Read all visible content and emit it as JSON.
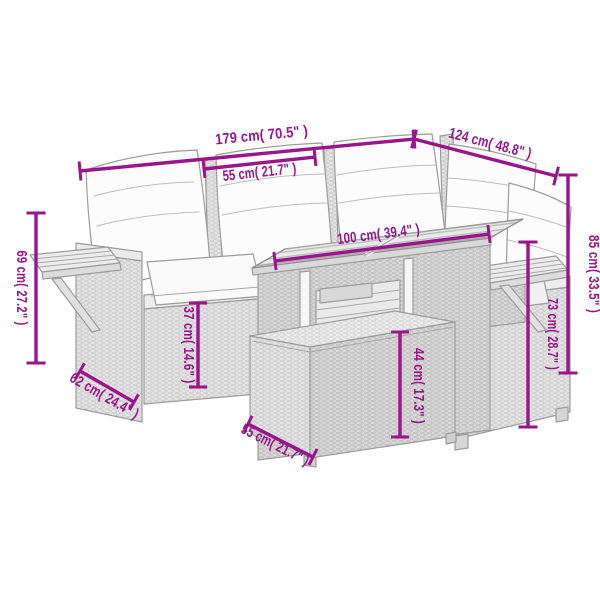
{
  "illustration": {
    "alt": "Line drawing of a 5-piece grey poly rattan garden lounge set: corner sofa with white cushions, side shelves on the armrests, a table with slatted wood top and a footstool, annotated with magenta dimension arrows",
    "colors": {
      "dimension_accent": "#9a148b",
      "furniture_fill": "#e4e4e4",
      "furniture_line": "#9c9c9c",
      "cushion_fill": "#fcfcfc",
      "background": "#ffffff"
    }
  },
  "dimensions": {
    "total_width": {
      "label": "179 cm( 70.5\" )"
    },
    "total_depth": {
      "label": "124 cm( 48.8\" )"
    },
    "seat_width": {
      "label": "55 cm( 21.7\" )"
    },
    "table_length": {
      "label": "100 cm( 39.4\" )"
    },
    "total_height": {
      "label": "85 cm( 33.5\" )"
    },
    "armrest_height": {
      "label": "73 cm( 28.7\" )"
    },
    "shelf_height": {
      "label": "69 cm( 27.2\" )"
    },
    "seat_height": {
      "label": "37 cm( 14.6\" )"
    },
    "stool_height": {
      "label": "44 cm( 17.3\" )"
    },
    "module_depth": {
      "label": "62 cm( 24.4\" )"
    },
    "stool_width": {
      "label": "55 cm( 21.7\" )"
    }
  }
}
